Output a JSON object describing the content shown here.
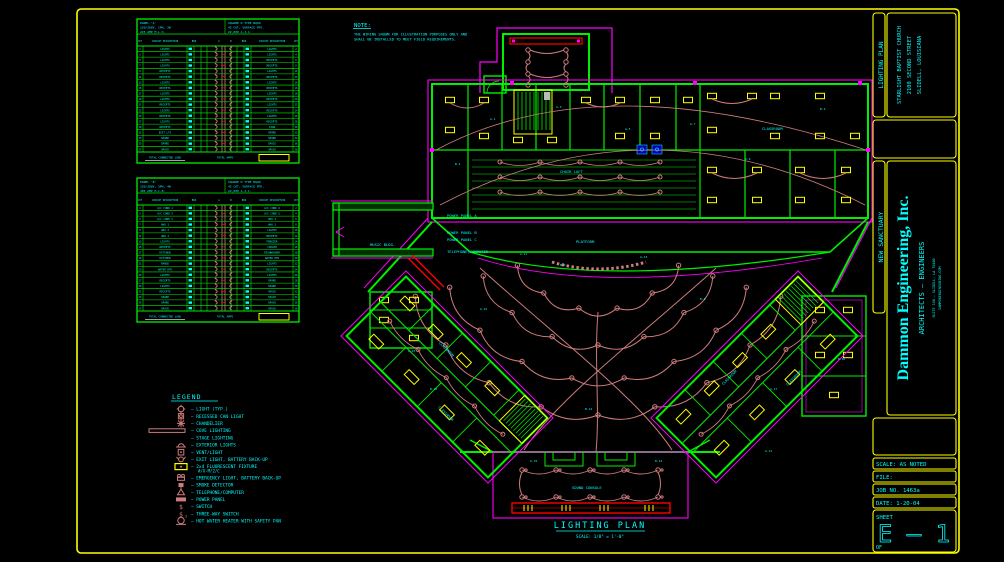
{
  "colors": {
    "bg": "#000000",
    "frame": "#FFFF00",
    "text": "#00FFFF",
    "walls": "#00F000",
    "dims": "#FF00FF",
    "wiring": "#CE7B7B",
    "fixture": "#FFFF00",
    "alert": "#FF0000",
    "panelbox": "#0000BB",
    "white": "#FFFFFF"
  },
  "sheet": {
    "titleblock": {
      "project_title": "LIGHTING PLAN",
      "client_line1": "STARLIGHT BAPTIST CHURCH",
      "client_line2": "2100 SECOND STREET",
      "client_line3": "SLIDELL, LOUISIANA",
      "project_name": "NEW SANCTUARY",
      "firm_name": "Dammon Engineering, Inc.",
      "firm_sub": "ARCHITECTS — ENGINEERS",
      "firm_addr1": "SUITE 100 — SLIDELL, LA 70460",
      "firm_addr2": "DAMMONENGINEERING.COM",
      "scale_label": "SCALE: AS NOTED",
      "file_label": "FILE:",
      "job_label": "JOB NO. 1463a",
      "date_label": "DATE: 1-20-04",
      "sheet_word": "SHEET",
      "sheet_number": "E — 1",
      "of_label": "OF"
    }
  },
  "note": {
    "title": "NOTE:",
    "line1": "THE WIRING SHOWN FOR ILLUSTRATION PURPOSES ONLY AND",
    "line2": "SHALL BE INSTALLED TO MEET FIELD REQUIREMENTS."
  },
  "plan": {
    "title": "LIGHTING PLAN",
    "scale": "SCALE: 1/8\" = 1'-0\"",
    "wing_label": "CLASSROOM",
    "labels": [
      "CHOIR LOFT",
      "PLATFORM",
      "POWER PANEL A",
      "POWER PANEL B",
      "POWER PANEL C",
      "TELEPHONE/COMPUTER",
      "MUSIC BLDG.",
      "SOUND CONSOLE",
      "CLASSROOM"
    ],
    "circuit_tags": [
      "A-1",
      "A-3",
      "A-5",
      "A-7",
      "B-2",
      "B-4",
      "A-9",
      "A-11",
      "B-6",
      "A-13",
      "B-8",
      "A-15",
      "B-10",
      "A-17",
      "B-12",
      "A-19",
      "B-14",
      "A-21",
      "B-16",
      "A-23"
    ]
  },
  "legend": {
    "title": "LEGEND",
    "items": [
      {
        "symbol": "light-icon",
        "label": "LIGHT (TYP.)"
      },
      {
        "symbol": "recessed-can-icon",
        "label": "RECESSED CAN LIGHT"
      },
      {
        "symbol": "chandelier-icon",
        "label": "CHANDELIER"
      },
      {
        "symbol": "cove-icon",
        "label": "COVE LIGHTING"
      },
      {
        "symbol": "stage-icon",
        "label": "STAGE LIGHTING"
      },
      {
        "symbol": "exterior-icon",
        "label": "EXTERIOR LIGHTS"
      },
      {
        "symbol": "vent-light-icon",
        "label": "VENT/LIGHT"
      },
      {
        "symbol": "exit-icon",
        "label": "EXIT LIGHT, BATTERY BACK-UP"
      },
      {
        "symbol": "fluorescent-icon",
        "label": "2x4 FLUORESCENT FIXTURE",
        "sublabel": "#/X-M/2/C"
      },
      {
        "symbol": "emergency-icon",
        "label": "EMERGENCY LIGHT, BATTERY BACK-UP"
      },
      {
        "symbol": "smoke-icon",
        "label": "SMOKE DETECTOR"
      },
      {
        "symbol": "telephone-icon",
        "label": "TELEPHONE/COMPUTER"
      },
      {
        "symbol": "panel-icon",
        "label": "POWER PANEL"
      },
      {
        "symbol": "switch-icon",
        "label": "SWITCH"
      },
      {
        "symbol": "three-way-icon",
        "label": "THREE-WAY SWITCH"
      },
      {
        "symbol": "water-heater-icon",
        "label": "HOT WATER HEATER WITH SAFETY PAN"
      }
    ]
  },
  "panels": [
    {
      "name": "PANEL 'A'",
      "header_left": [
        "PANEL 'A'",
        "120/208V, 1PH, 3W",
        "225 AMP M.L.O."
      ],
      "header_right": [
        "SQUARE D TYPE NQOD",
        "42 CKT, SURFACE MTD.",
        "22,000 A.I.C."
      ],
      "col_desc": "CIRCUIT DESCRIPTION",
      "col_ckt": "CKT",
      "col_bkr": "BKR",
      "col_a": "A",
      "col_b": "B",
      "circuits_left": [
        "LIGHTS",
        "LIGHTS",
        "LIGHTS",
        "LIGHTS",
        "RECEPTS",
        "RECEPTS",
        "LIGHTS",
        "RECEPTS",
        "LIGHTS",
        "LIGHTS",
        "RECEPTS",
        "LIGHTS",
        "RECEPTS",
        "LIGHTS",
        "RECEPTS",
        "EXIT LTS",
        "SPARE",
        "SPARE",
        "SPACE"
      ],
      "circuits_right": [
        "LIGHTS",
        "LIGHTS",
        "RECEPTS",
        "RECEPTS",
        "LIGHTS",
        "RECEPTS",
        "LIGHTS",
        "RECEPTS",
        "LIGHTS",
        "RECEPTS",
        "LIGHTS",
        "RECEPTS",
        "LIGHTS",
        "RECEPTS",
        "SIGN",
        "SPARE",
        "SPARE",
        "SPACE",
        "SPACE"
      ],
      "footer_left": "TOTAL CONNECTED LOAD",
      "footer_right": "TOTAL AMPS"
    },
    {
      "name": "PANEL 'B'",
      "header_left": [
        "PANEL 'B'",
        "120/208V, 3PH, 4W",
        "400 AMP M.C.B."
      ],
      "header_right": [
        "SQUARE D TYPE NQOD",
        "42 CKT, SURFACE MTD.",
        "22,000 A.I.C."
      ],
      "col_desc": "CIRCUIT DESCRIPTION",
      "col_ckt": "CKT",
      "col_bkr": "BKR",
      "col_a": "A",
      "col_b": "B",
      "circuits_left": [
        "A/C COND 1",
        "A/C COND 2",
        "A/C COND 3",
        "AHU 1",
        "AHU 2",
        "AHU 3",
        "LIGHTS",
        "RECEPTS",
        "KITCHEN",
        "KITCHEN",
        "RANGE",
        "WATER HTR",
        "LIGHTS",
        "RECEPTS",
        "LIGHTS",
        "RECEPTS",
        "SPARE",
        "SPARE",
        "SPACE"
      ],
      "circuits_right": [
        "A/C COND 4",
        "A/C COND 5",
        "AHU 4",
        "AHU 5",
        "LIGHTS",
        "RECEPTS",
        "FREEZER",
        "COOLER",
        "DISHWASHER",
        "WATER HTR",
        "LIGHTS",
        "RECEPTS",
        "LIGHTS",
        "SPARE",
        "SPARE",
        "SPACE",
        "SPACE",
        "SPACE",
        "SPACE"
      ],
      "footer_left": "TOTAL CONNECTED LOAD",
      "footer_right": "TOTAL AMPS"
    }
  ]
}
